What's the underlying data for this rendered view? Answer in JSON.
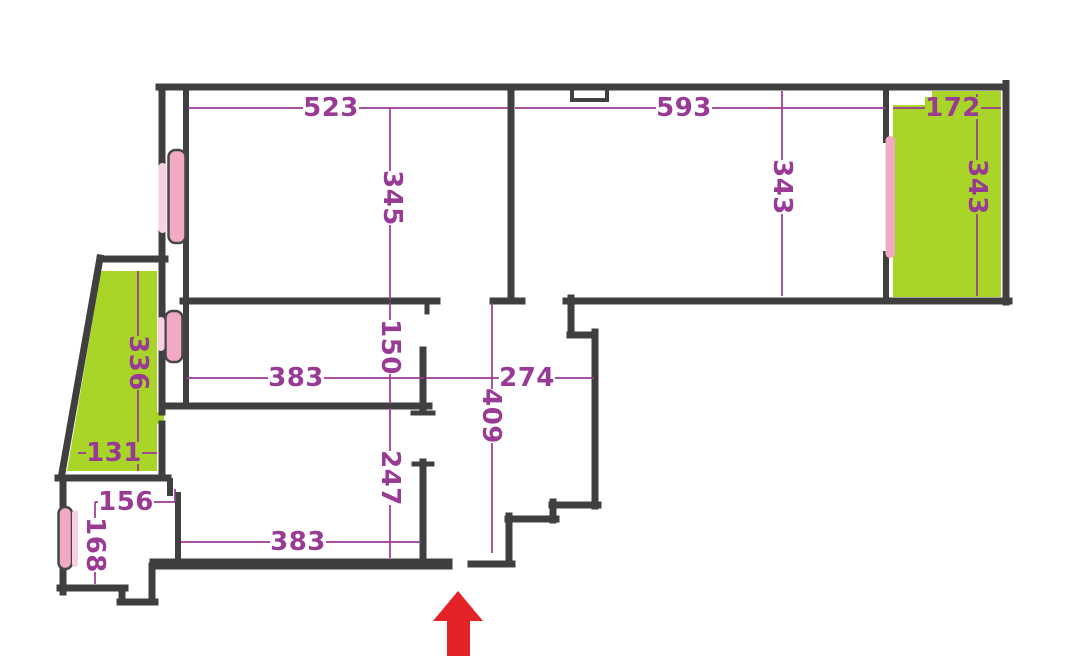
{
  "title": "apartment-floor-plan",
  "colors": {
    "wall": "#3f3f3f",
    "balcony_green": "#a9d428",
    "window_pink": "#f2a9c6",
    "window_pink_light": "#f8d0e0",
    "dimension_purple": "#993a94",
    "arrow_red": "#e42328",
    "background": "#ffffff"
  },
  "dimensions": {
    "top_left_room_width": "523",
    "top_right_room_width": "593",
    "right_balcony_width": "172",
    "top_left_room_depth": "345",
    "top_right_room_depth": "343",
    "right_balcony_depth": "343",
    "left_balcony_depth": "336",
    "inner_corridor_opening": "150",
    "middle_room_width": "383",
    "entry_hall_width": "274",
    "entry_hall_depth": "409",
    "left_balcony_width": "131",
    "lower_room_depth": "247",
    "small_room_width": "156",
    "small_room_depth": "168",
    "lower_room_width": "383"
  },
  "icons": {
    "entrance_arrow": "up-arrow"
  }
}
